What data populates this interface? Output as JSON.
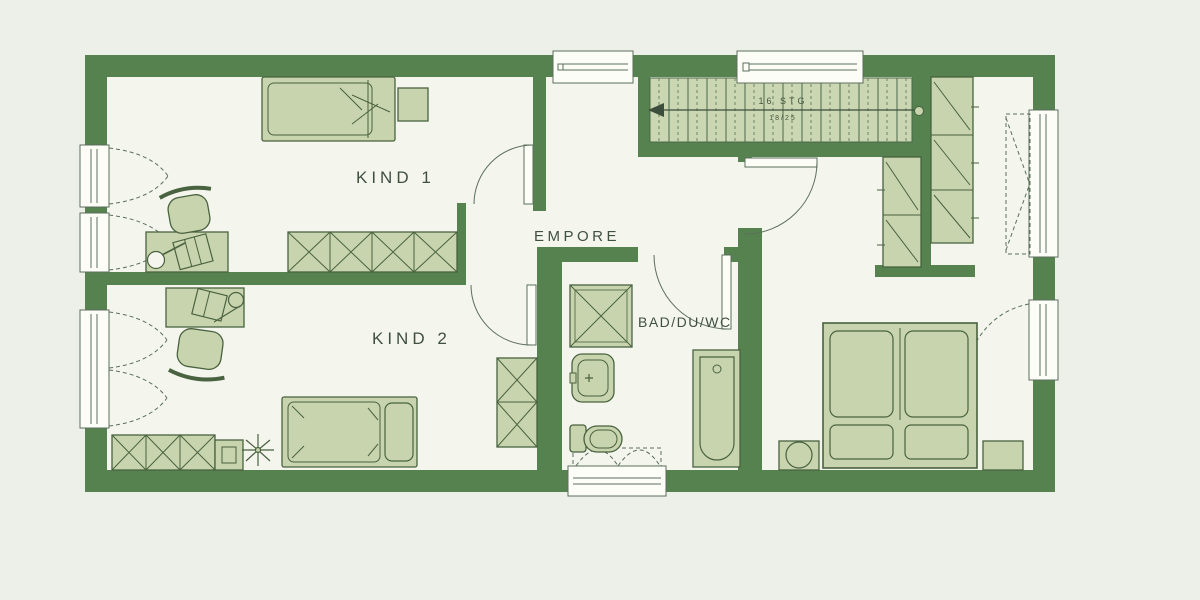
{
  "plan": {
    "type": "floorplan-upper-storey",
    "rooms": {
      "kind1": {
        "label": "KIND 1"
      },
      "kind2": {
        "label": "KIND 2"
      },
      "empore": {
        "label": "EMPORE"
      },
      "bad": {
        "label": "BAD/DU/WC"
      },
      "schlafen": {
        "label": ""
      }
    },
    "stairs": {
      "annotation_top": "16 STG",
      "annotation_bottom": "18/25",
      "direction_arrow": "left"
    },
    "colors": {
      "wall_green": "#56824f",
      "furniture_fill": "#c8d4ae",
      "furniture_stroke": "#49623f",
      "floor": "#f4f5ed",
      "background": "#edf0e8",
      "window_white": "#fcfdf7",
      "line": "#5c6e5c",
      "text": "#40503f"
    },
    "furniture_icons": {
      "kind1": [
        "single-bed-icon",
        "side-table-icon",
        "desk-icon",
        "desk-chair-icon",
        "desk-lamp-icon",
        "wardrobe-x-icon"
      ],
      "kind2": [
        "single-bed-icon",
        "desk-icon",
        "desk-chair-icon",
        "wardrobe-x-icon",
        "cabinet-icon",
        "plant-icon"
      ],
      "bad": [
        "shower-icon",
        "washbasin-icon",
        "toilet-icon",
        "bathtub-icon"
      ],
      "schlafen": [
        "double-bed-icon",
        "nightstand-lamp-icon",
        "nightstand-icon",
        "wardrobe-diagonal-icon"
      ],
      "circulation": [
        "staircase-icon",
        "door-swing-icon",
        "window-icon"
      ]
    }
  }
}
